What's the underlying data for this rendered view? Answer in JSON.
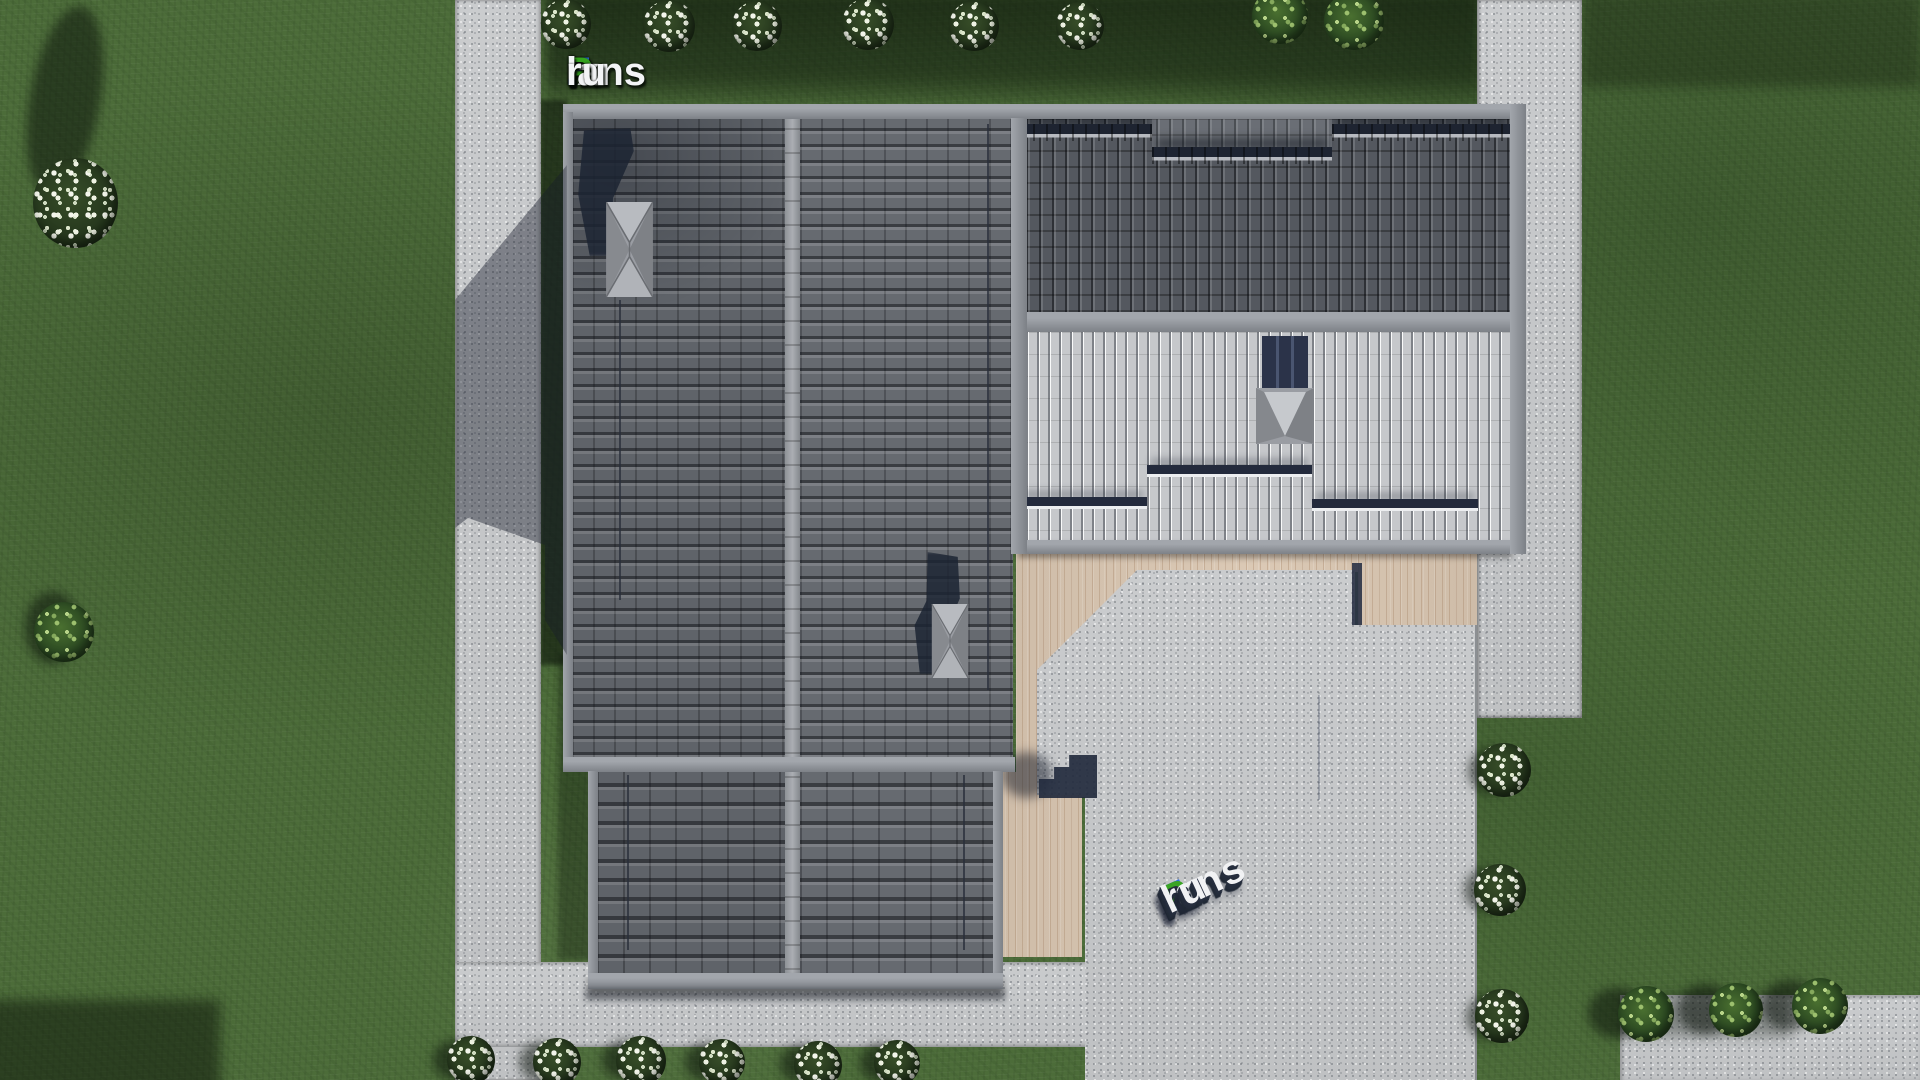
{
  "branding": {
    "logo_text": "FixPlans.ru",
    "logo_segments": [
      {
        "text": "F",
        "color": "#2d6de2"
      },
      {
        "text": "ix",
        "color": "#f3f4f6"
      },
      {
        "text": "P",
        "color": "#35a31f"
      },
      {
        "text": "lans",
        "color": "#f3f4f6"
      },
      {
        "text": ".",
        "color": "#2d6de2"
      },
      {
        "text": "ru",
        "color": "#f3f4f6"
      }
    ],
    "ground_watermark_text": "FixPlans.ru"
  },
  "palette": {
    "lawn_green": "#4c6c39",
    "lawn_shadow": "#182a14",
    "concrete": "#c8cacc",
    "deck_wood": "#dac7b2",
    "roof_tiles_dark": "#5e6268",
    "roof_wing_dark": "#53575e",
    "roof_metal_light": "#c6c8cb",
    "ridge_gray": "#989ca2",
    "navy_shadow": "#222a3d",
    "logo_blue": "#2d6de2",
    "logo_green": "#35a31f"
  },
  "scene": {
    "view": "top-down aerial render of a house",
    "house": {
      "roof_sections": [
        "main gable roof",
        "dark tiled right wing",
        "light seam-metal wing",
        "lower gable extension"
      ],
      "skylights": 3,
      "chimneys": 2,
      "snow_guard_rows": 6,
      "exterior_stairs": 1
    },
    "landscape": {
      "hardscape": [
        "left walkway",
        "right walkway",
        "bottom walkway",
        "patio",
        "wooden deck",
        "corner pad"
      ],
      "white_flower_bushes": 15,
      "green_trees": 7
    }
  }
}
